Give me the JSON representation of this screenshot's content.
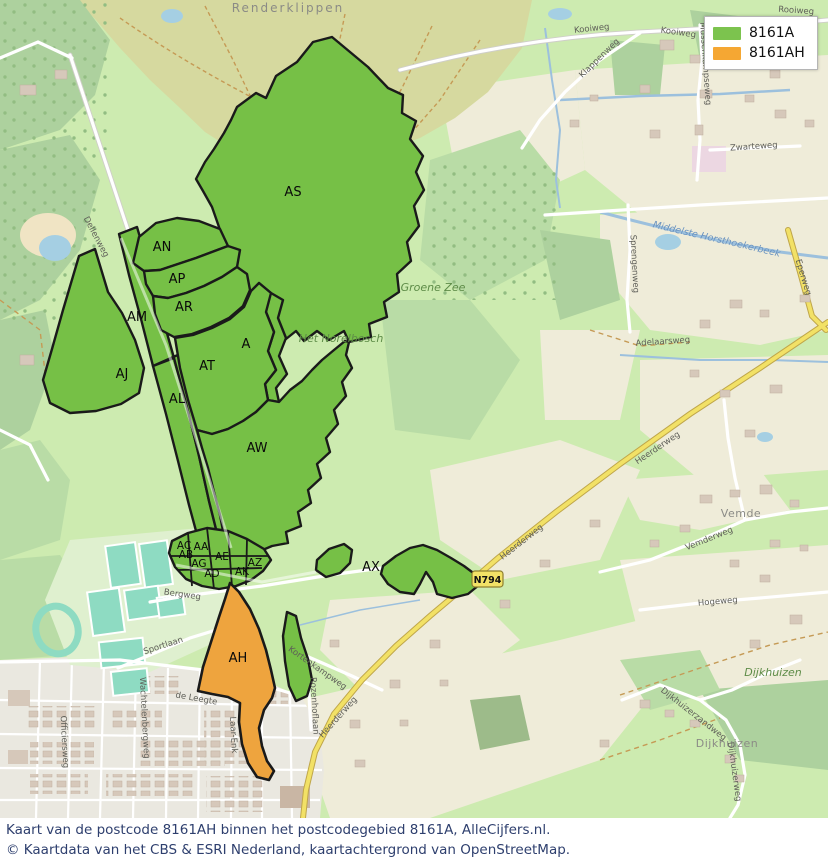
{
  "legend": {
    "items": [
      {
        "label": "8161A",
        "color": "#7cc34e"
      },
      {
        "label": "8161AH",
        "color": "#f5a733"
      }
    ]
  },
  "overlay": {
    "green_fill": "#76c046",
    "orange_fill": "#eea43e",
    "outline": "#1a1a1a",
    "regions": [
      {
        "code": "AS"
      },
      {
        "code": "AN"
      },
      {
        "code": "AP"
      },
      {
        "code": "AR"
      },
      {
        "code": "AM"
      },
      {
        "code": "AJ"
      },
      {
        "code": "A"
      },
      {
        "code": "AT"
      },
      {
        "code": "AL"
      },
      {
        "code": "AW"
      },
      {
        "code": "AC"
      },
      {
        "code": "AA"
      },
      {
        "code": "AB"
      },
      {
        "code": "AE"
      },
      {
        "code": "AG"
      },
      {
        "code": "AD"
      },
      {
        "code": "AK"
      },
      {
        "code": "AZ"
      },
      {
        "code": "AX"
      },
      {
        "code": "AH"
      }
    ]
  },
  "map_labels": {
    "places": [
      {
        "text": "Renderklippen"
      },
      {
        "text": "Groene Zee"
      },
      {
        "text": "Het Norelbosch"
      },
      {
        "text": "Vemde"
      },
      {
        "text": "Dijkhuizen"
      },
      {
        "text": "Dijkhuizen"
      }
    ],
    "roads": [
      {
        "text": "Kooiweg"
      },
      {
        "text": "Kooiweg"
      },
      {
        "text": "Rooiweg"
      },
      {
        "text": "Klappenweg"
      },
      {
        "text": "Mussenkampseweg"
      },
      {
        "text": "Dellenweg"
      },
      {
        "text": "Sprengenweg"
      },
      {
        "text": "Eperweg"
      },
      {
        "text": "Heerderweg"
      },
      {
        "text": "Heerderweg"
      },
      {
        "text": "Heerderweg"
      },
      {
        "text": "Vemderweg"
      },
      {
        "text": "Hogeweg"
      },
      {
        "text": "Dijkhuizerzandweg"
      },
      {
        "text": "Dijkhuizerweg"
      },
      {
        "text": "Kortenkampweg"
      },
      {
        "text": "Rozenhoflaan"
      },
      {
        "text": "de Leegte"
      },
      {
        "text": "Laar-Enk"
      },
      {
        "text": "Sportlaan"
      },
      {
        "text": "Bergweg"
      },
      {
        "text": "Zwarteweg"
      },
      {
        "text": "Adelaarsweg"
      },
      {
        "text": "Wachtelenbergweg"
      },
      {
        "text": "Officiersweg"
      }
    ],
    "water": [
      {
        "text": "Middelste Horsthoekerbeek"
      }
    ],
    "road_shield": "N794"
  },
  "caption": {
    "line1": "Kaart van de postcode 8161AH binnen het postcodegebied 8161A, AlleCijfers.nl.",
    "line2": "© Kaartdata van het CBS & ESRI Nederland, kaartachtergrond van OpenStreetMap."
  }
}
